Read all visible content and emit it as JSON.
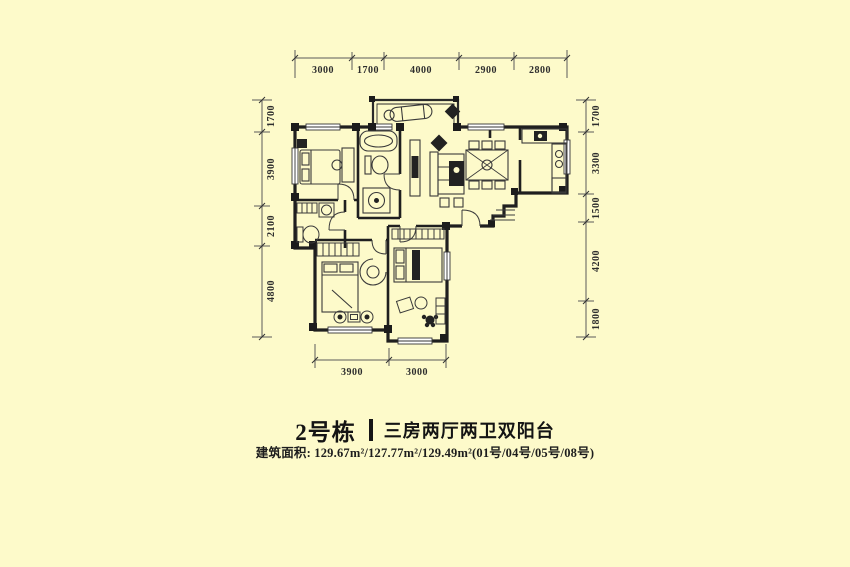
{
  "canvas": {
    "background": "#FDFACA",
    "wall_ink": "#1f1f1f"
  },
  "plan": {
    "dimensions": {
      "top": [
        "3000",
        "1700",
        "4000",
        "2900",
        "2800"
      ],
      "left": [
        "1700",
        "3900",
        "2100",
        "4800"
      ],
      "right": [
        "1700",
        "3300",
        "1500",
        "4200",
        "1800"
      ],
      "bottom": [
        "3900",
        "3000"
      ]
    }
  },
  "caption": {
    "building": "2号栋",
    "divider": "|",
    "layout": "三房两厅两卫双阳台",
    "area_line": "建筑面积: 129.67m²/127.77m²/129.49m²(01号/04号/05号/08号)"
  }
}
